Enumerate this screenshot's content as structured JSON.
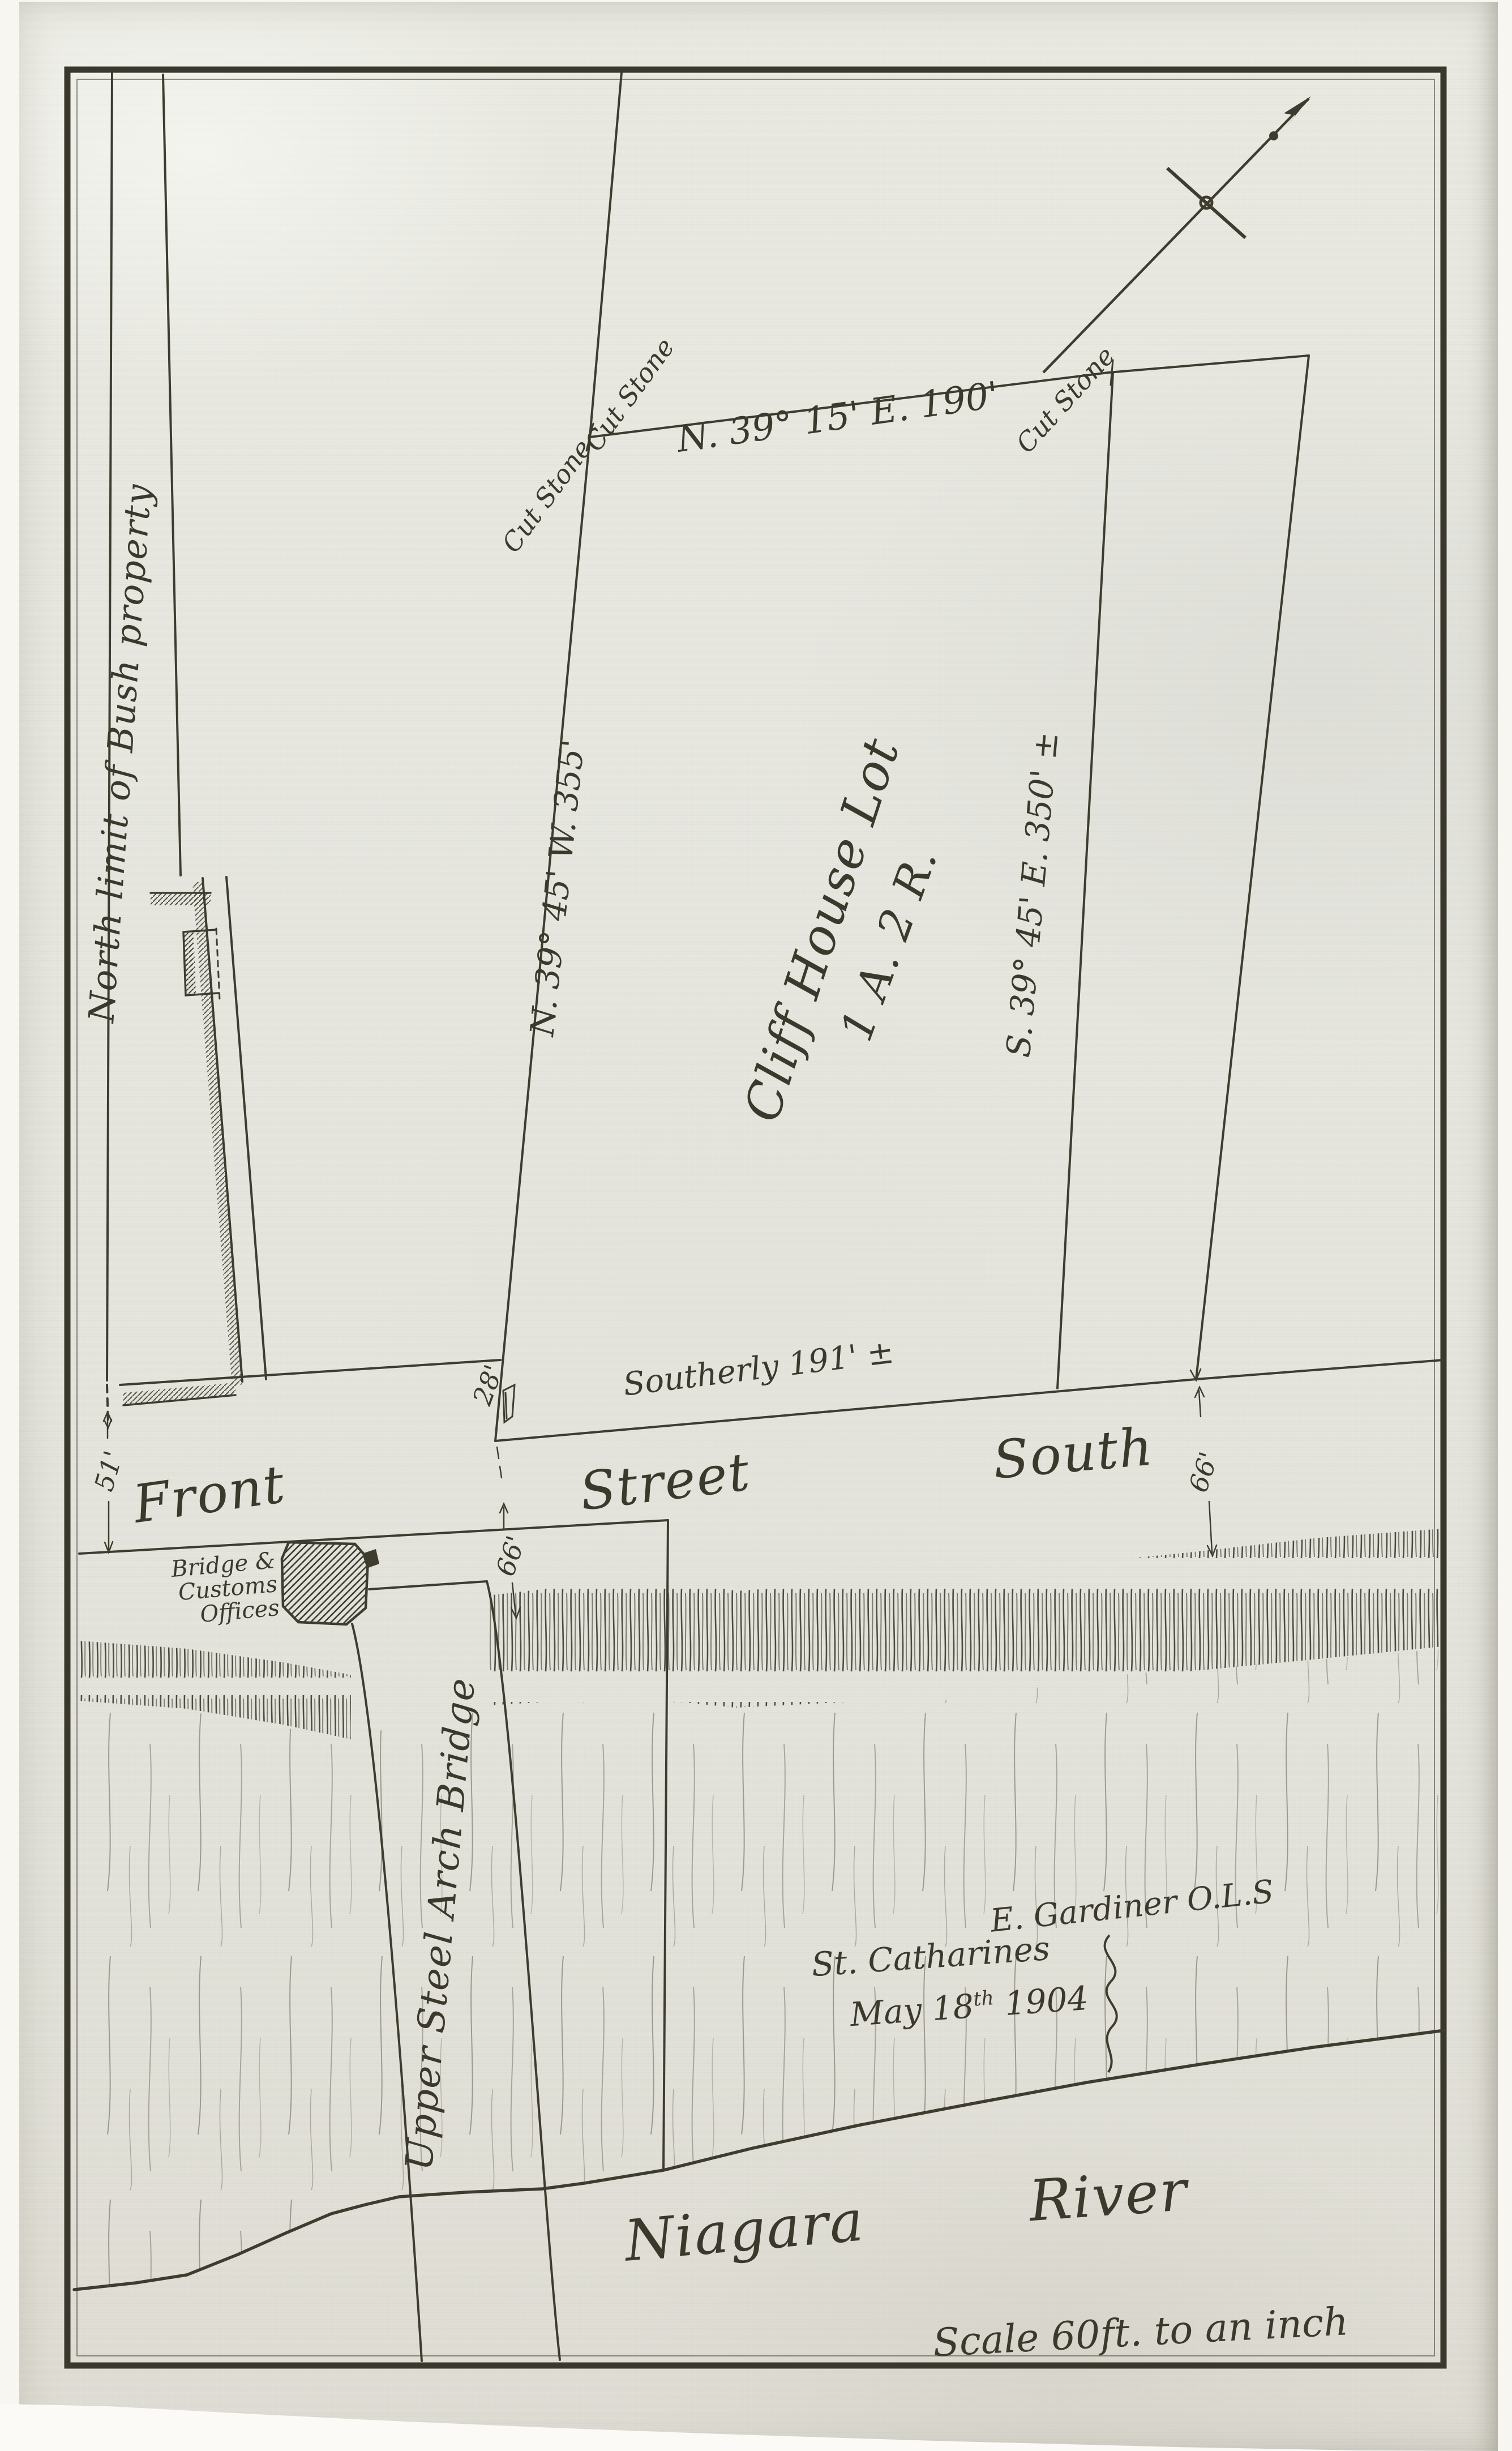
{
  "labels": {
    "north_limit": "North limit of Bush property",
    "cut_stone_1": "Cut Stone",
    "cut_stone_2": "Cut Stone",
    "cut_stone_3": "Cut Stone",
    "north_bearing": "N. 39° 15' E.  190'",
    "west_bearing": "N. 39° 45' W.  355'",
    "east_bearing": "S. 39° 45' E.  350' ±",
    "lot_name": "Cliff House Lot",
    "lot_area": "1 A. 2 R.",
    "southerly": "Southerly  191' ±",
    "dim_28": "28'",
    "dim_51": "51'",
    "dim_66_mid": "66'",
    "dim_66_right": "66'",
    "street_front": "Front",
    "street_street": "Street",
    "street_south": "South",
    "building_line1": "Bridge &",
    "building_line2": "Customs",
    "building_line3": "Offices",
    "bridge": "Upper Steel Arch Bridge",
    "surveyor": "E. Gardiner O.L.S",
    "place": "St. Catharines",
    "date_pre": "May 18",
    "date_sup": "th",
    "date_post": " 1904",
    "river_word1": "Niagara",
    "river_word2": "River",
    "scale_note": "Scale 60ft. to an inch"
  },
  "colors": {
    "ink": "#3e3c2f",
    "paper": "#e7e7e0",
    "background": "#f7f6f1"
  }
}
